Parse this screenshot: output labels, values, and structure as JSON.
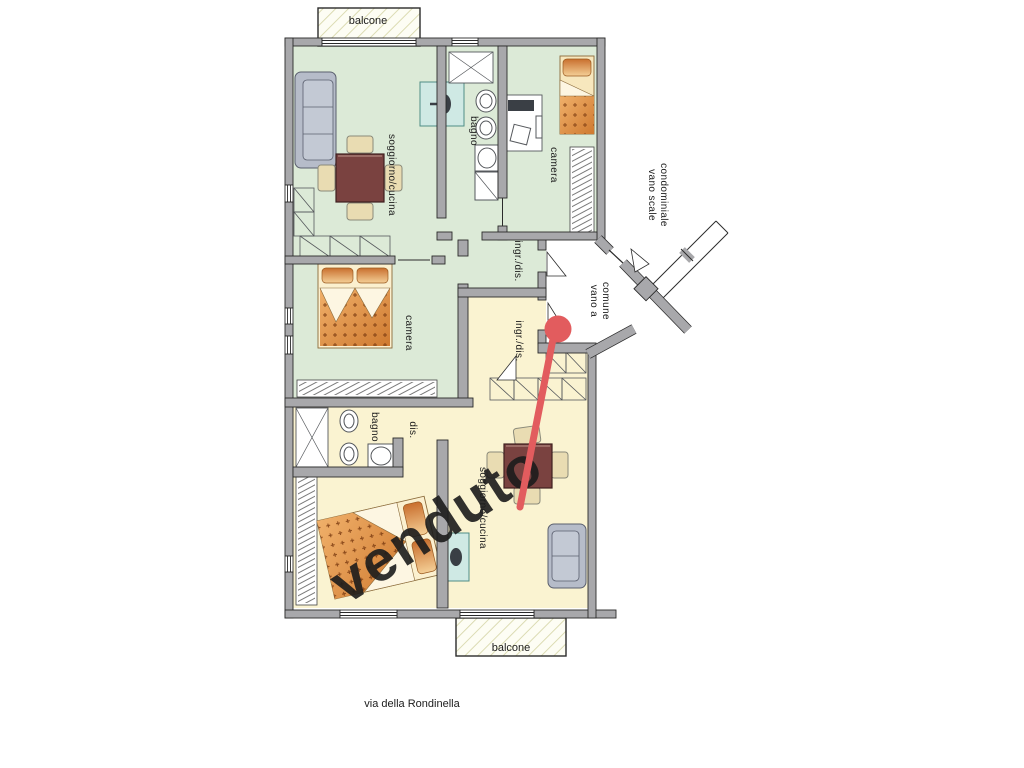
{
  "plan": {
    "street_label": "via della Rondinella",
    "balcony_top": "balcone",
    "balcony_bottom": "balcone",
    "apartment_green": {
      "living_kitchen": "soggiorno/cucina",
      "bathroom": "bagno",
      "bedroom_right": "camera",
      "bedroom_left": "camera",
      "entry_hall": "ingr./dis."
    },
    "apartment_yellow": {
      "living_kitchen": "soggiorno/cucina",
      "bathroom": "bagno",
      "hallway": "dis.",
      "entry_hall": "ingr./dis.",
      "status_stamp": "venduto"
    },
    "common_areas": {
      "stairwell_line1": "vano scale",
      "stairwell_line2": "condominiale",
      "shared_hall_line1": "vano a",
      "shared_hall_line2": "comune"
    },
    "colors": {
      "wall": "#a8a8ab",
      "floor_green": "#dcead7",
      "floor_yellow": "#faf3d1",
      "stamp_red": "#d25050",
      "pin_red": "#e25c5e",
      "sofa": "#b6bcc9",
      "table": "#7a4240",
      "chair": "#e9dcb2",
      "kitchen_unit": "#cfe9e4",
      "bed_orange": "#dd8a3c",
      "bed_light": "#f7e7bd"
    }
  }
}
